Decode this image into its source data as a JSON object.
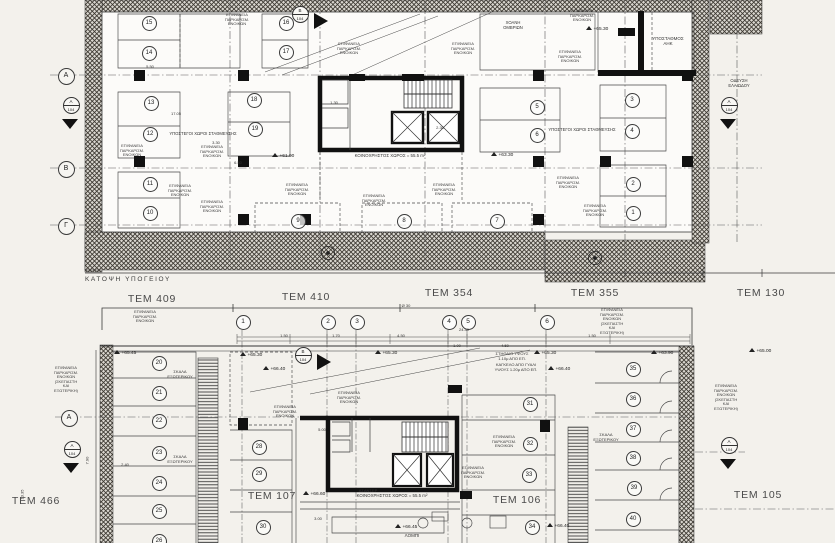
{
  "colors": {
    "paper": "#f3f1ec",
    "ink": "#222222",
    "wall": "#111111",
    "hatch_bg": "#dcd9d2"
  },
  "captions": {
    "basement": "ΚΑΤΟΨΗ ΥΠΟΓΕΙΟΥ"
  },
  "parcels": {
    "top": [
      [
        "TEM 409",
        152,
        293
      ],
      [
        "TEM 410",
        306,
        291
      ],
      [
        "TEM 354",
        449,
        287
      ],
      [
        "TEM 355",
        595,
        287
      ],
      [
        "TEM 130",
        761,
        287
      ]
    ],
    "bottom": [
      [
        "TEM 466",
        36,
        495
      ],
      [
        "TEM 107",
        272,
        490
      ],
      [
        "TEM 106",
        517,
        494
      ],
      [
        "TEM 105",
        758,
        489
      ]
    ]
  },
  "grid": {
    "letters": [
      [
        "A",
        65,
        75
      ],
      [
        "B",
        65,
        168
      ],
      [
        "Γ",
        65,
        225
      ],
      [
        "A",
        68,
        417
      ]
    ],
    "numbers": [
      [
        "1",
        242,
        321
      ],
      [
        "2",
        327,
        321
      ],
      [
        "3",
        356,
        321
      ],
      [
        "4",
        448,
        321
      ],
      [
        "5",
        467,
        321
      ],
      [
        "6",
        546,
        321
      ]
    ]
  },
  "section_markers": [
    [
      "A",
      "104",
      70,
      104
    ],
    [
      "A",
      "104",
      728,
      104
    ],
    [
      "B",
      "104",
      299,
      13
    ],
    [
      "B",
      "104",
      302,
      354
    ],
    [
      "A",
      "104",
      71,
      448
    ],
    [
      "A",
      "104",
      728,
      444
    ]
  ],
  "stalls": {
    "basement": [
      [
        "15",
        148,
        22
      ],
      [
        "14",
        148,
        52
      ],
      [
        "16",
        285,
        22
      ],
      [
        "17",
        285,
        51
      ],
      [
        "13",
        150,
        102
      ],
      [
        "12",
        149,
        133
      ],
      [
        "18",
        253,
        99
      ],
      [
        "19",
        254,
        128
      ],
      [
        "11",
        149,
        183
      ],
      [
        "10",
        149,
        212
      ],
      [
        "9",
        297,
        220
      ],
      [
        "8",
        403,
        220
      ],
      [
        "7",
        496,
        220
      ],
      [
        "5",
        536,
        106
      ],
      [
        "6",
        536,
        134
      ],
      [
        "3",
        631,
        99
      ],
      [
        "4",
        631,
        130
      ],
      [
        "2",
        632,
        183
      ],
      [
        "1",
        632,
        212
      ]
    ],
    "ground": [
      [
        "20",
        158,
        362
      ],
      [
        "21",
        158,
        392
      ],
      [
        "22",
        158,
        420
      ],
      [
        "23",
        158,
        452
      ],
      [
        "24",
        158,
        482
      ],
      [
        "25",
        158,
        510
      ],
      [
        "26",
        158,
        540
      ],
      [
        "28",
        258,
        446
      ],
      [
        "29",
        258,
        473
      ],
      [
        "30",
        262,
        526
      ],
      [
        "31",
        529,
        403
      ],
      [
        "32",
        529,
        443
      ],
      [
        "33",
        528,
        474
      ],
      [
        "34",
        531,
        526
      ],
      [
        "35",
        632,
        368
      ],
      [
        "36",
        632,
        398
      ],
      [
        "37",
        632,
        428
      ],
      [
        "38",
        632,
        457
      ],
      [
        "39",
        633,
        487
      ],
      [
        "40",
        632,
        518
      ]
    ]
  },
  "elevations": [
    [
      "+61.90",
      272,
      153
    ],
    [
      "+63.30",
      491,
      152
    ],
    [
      "+65.30",
      586,
      26
    ],
    [
      "+65.45",
      114,
      350
    ],
    [
      "+65.30",
      240,
      352
    ],
    [
      "+66.40",
      263,
      366
    ],
    [
      "+65.30",
      375,
      350
    ],
    [
      "+65.30",
      534,
      350
    ],
    [
      "+66.40",
      548,
      366
    ],
    [
      "+63.90",
      651,
      350
    ],
    [
      "+65.00",
      749,
      348
    ],
    [
      "+66.60",
      303,
      491
    ],
    [
      "+66.45",
      395,
      524
    ],
    [
      "+66.40",
      547,
      523
    ]
  ],
  "texts": [
    {
      "t": "ΚΟΙΝΟΧΡΗΣΤΟΣ ΧΩΡΟΣ = 55.5 m²",
      "x": 390,
      "y": 153,
      "s": 4.4
    },
    {
      "t": "ΚΟΙΝΟΧΡΗΣΤΟΣ ΧΩΡΟΣ = 55.5 m²",
      "x": 392,
      "y": 493,
      "s": 4.4
    },
    {
      "t": "ΥΠΟΣΤΑΘΜΟΣ\nΑΗΚ",
      "x": 668,
      "y": 36,
      "s": 4.5
    },
    {
      "t": "ΥΠΟΣΤΕΓΟΙ ΧΩΡΟΙ ΣΤΑΘΜΕΥΣΗΣ",
      "x": 203,
      "y": 132,
      "s": 4.2
    },
    {
      "t": "ΥΠΟΣΤΕΓΟΙ ΧΩΡΟΙ ΣΤΑΘΜΕΥΣΗΣ",
      "x": 582,
      "y": 128,
      "s": 4.2
    },
    {
      "t": "ΧΟΑΝΗ\nΟΜΒΡΙΩΝ",
      "x": 513,
      "y": 21,
      "s": 4.2
    },
    {
      "t": "ΟΔΕΥΣΗ\nΕΛΑΙΩΔΟΥ",
      "x": 739,
      "y": 79,
      "s": 4.2
    },
    {
      "t": "ΛΟΜΠΙ",
      "x": 412,
      "y": 533,
      "s": 4.5
    },
    {
      "t": "ΑΣΑΝΣΕΡ",
      "x": 368,
      "y": 489,
      "s": 4
    },
    {
      "t": "ΣΤΗΘΑΙΟ ΥΨΟΥΣ\n1.10μ ΑΠΟ ΕΠ.",
      "x": 512,
      "y": 352,
      "s": 4
    },
    {
      "t": "ΚΑΓΚΕΛΟ ΑΠΟ ΓΥΑΛΙ\nΥΨΟΥΣ 1.20μ ΑΠΟ ΕΠ.",
      "x": 516,
      "y": 363,
      "s": 4
    },
    {
      "t": "ΣΚΑΛΑ\nΕΞΩΤΕΡΙΚΟΥ",
      "x": 180,
      "y": 370,
      "s": 4
    },
    {
      "t": "ΣΚΑΛΑ\nΕΞΩΤΕΡΙΚΟΥ",
      "x": 180,
      "y": 455,
      "s": 4
    },
    {
      "t": "ΣΚΑΛΑ\nΕΞΩΤΕΡΙΚΟΥ",
      "x": 606,
      "y": 433,
      "s": 4
    }
  ],
  "parking_notes": {
    "short": "ΕΠΙΦΑΝΕΙΑ\nΠΑΡΚΑΡΙΣΜ.\nΕΝΟΙΚΩΝ",
    "long": "ΕΠΙΦΑΝΕΙΑ\nΠΑΡΚΑΡΙΣΜ.\nΕΝΟΙΚΩΝ\n(ΣΚΕΠΑΣΤΗ\nΚΑΙ\nΕΞΩΤΕΡΙΚΗ)",
    "short_at": [
      [
        237,
        13
      ],
      [
        349,
        42
      ],
      [
        463,
        42
      ],
      [
        582,
        9
      ],
      [
        570,
        50
      ],
      [
        132,
        144
      ],
      [
        212,
        145
      ],
      [
        180,
        184
      ],
      [
        212,
        200
      ],
      [
        297,
        183
      ],
      [
        374,
        194
      ],
      [
        444,
        183
      ],
      [
        568,
        176
      ],
      [
        595,
        204
      ],
      [
        145,
        310
      ],
      [
        285,
        405
      ],
      [
        349,
        391
      ],
      [
        504,
        435
      ],
      [
        473,
        466
      ]
    ],
    "long_at": [
      [
        612,
        308
      ],
      [
        66,
        366
      ],
      [
        726,
        384
      ]
    ]
  },
  "dims": [
    [
      "1.50",
      284,
      333
    ],
    [
      "1.70",
      336,
      333
    ],
    [
      "4.50",
      401,
      333
    ],
    [
      "24.30",
      464,
      327
    ],
    [
      "1.00",
      457,
      343
    ],
    [
      "4.50",
      505,
      343
    ],
    [
      "1.50",
      592,
      333
    ],
    [
      "Ø 30",
      406,
      303
    ],
    [
      "5.50",
      150,
      64
    ],
    [
      "17.05",
      176,
      111
    ],
    [
      "1.30",
      334,
      100
    ],
    [
      "2.30",
      440,
      125
    ],
    [
      "5.00",
      322,
      427
    ],
    [
      "3.00",
      318,
      516
    ],
    [
      "2.40",
      125,
      462
    ],
    [
      "6.50",
      238,
      160
    ],
    [
      "3.30",
      216,
      140
    ],
    [
      "7.90",
      87,
      458,
      "v"
    ],
    [
      "13.35",
      22,
      492,
      "v"
    ]
  ]
}
